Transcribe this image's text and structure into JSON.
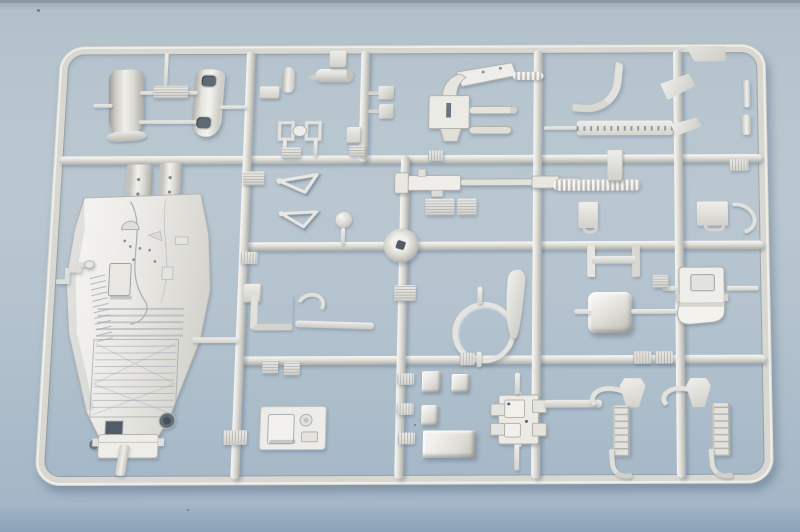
{
  "meta": {
    "type": "photograph",
    "subject": "Injection-molded plastic model kit sprue (parts runner) with unpainted light-gray parts, including a large cockpit/hull tub, intake cowls, a gun mount, a ring frame, a bucket seat, landing-gear struts and many small fittings",
    "surface": "light blue-gray tabletop with darker blue front edge at the bottom of the frame"
  },
  "palette": {
    "background_top_edge": "#8d99a4",
    "background_surface": "#b7c5cf",
    "table_edge_dark": "#8aa1b8",
    "plastic_base": "#dcdbd5",
    "plastic_highlight": "#f4f3ef",
    "plastic_shadow": "#aeada6",
    "slot_dark": "#5f6a76",
    "cast_shadow": "rgba(80,100,120,0.38)"
  },
  "sprue": {
    "frame": {
      "x": 0,
      "y": 0,
      "w": 740,
      "h": 466,
      "thickness": 9,
      "corner_radius": 26
    },
    "runners": [
      {
        "o": "h",
        "n": "runner-h1",
        "x": 6,
        "y": 121,
        "w": 728,
        "h": 9
      },
      {
        "o": "h",
        "n": "runner-h2",
        "x": 198,
        "y": 214,
        "w": 536,
        "h": 9
      },
      {
        "o": "h",
        "n": "runner-h3",
        "x": 198,
        "y": 334,
        "w": 536,
        "h": 9
      },
      {
        "o": "v",
        "n": "runner-v1",
        "x": 196,
        "y": 6,
        "w": 9,
        "h": 454
      },
      {
        "o": "v",
        "n": "runner-v2-top",
        "x": 316,
        "y": 6,
        "w": 9,
        "h": 122
      },
      {
        "o": "v",
        "n": "runner-v3",
        "x": 360,
        "y": 121,
        "w": 9,
        "h": 339
      },
      {
        "o": "v",
        "n": "runner-v4",
        "x": 497,
        "y": 6,
        "w": 9,
        "h": 454
      },
      {
        "o": "v",
        "n": "runner-v5",
        "x": 643,
        "y": 6,
        "w": 9,
        "h": 454
      }
    ],
    "parts": [
      {
        "t": "tab",
        "n": "corner-tab",
        "x": 656,
        "y": 2,
        "w": 42,
        "h": 17
      },
      {
        "t": "cowl",
        "n": "intake-cowl-left",
        "x": 54,
        "y": 26,
        "w": 36,
        "h": 74,
        "r": -3
      },
      {
        "t": "cowl2",
        "n": "intake-cowl-right",
        "x": 142,
        "y": 26,
        "w": 31,
        "h": 74,
        "r": 2
      },
      {
        "t": "stub",
        "n": "gate-bar",
        "x": 38,
        "y": 64,
        "w": 20,
        "h": 4
      },
      {
        "t": "stub",
        "n": "gate-bar",
        "x": 86,
        "y": 50,
        "w": 60,
        "h": 4
      },
      {
        "t": "stub",
        "n": "gate-bar",
        "x": 86,
        "y": 82,
        "w": 60,
        "h": 4
      },
      {
        "t": "stub",
        "n": "gate-bar",
        "x": 110,
        "y": 8,
        "w": 4,
        "h": 40
      },
      {
        "t": "stub",
        "n": "gate-bar",
        "x": 170,
        "y": 66,
        "w": 28,
        "h": 4
      },
      {
        "t": "vent",
        "n": "gate-plate",
        "x": 100,
        "y": 44,
        "w": 36,
        "h": 14
      },
      {
        "t": "cylv",
        "n": "small-cylinder",
        "x": 234,
        "y": 24,
        "w": 13,
        "h": 28
      },
      {
        "t": "bracketS",
        "n": "foot-bracket",
        "x": 211,
        "y": 45,
        "w": 21,
        "h": 14
      },
      {
        "t": "pod",
        "n": "cylinder-pod",
        "x": 268,
        "y": 26,
        "w": 40,
        "h": 15
      },
      {
        "t": "bracketS",
        "n": "pod-bracket",
        "x": 283,
        "y": 6,
        "w": 18,
        "h": 19
      },
      {
        "t": "twinframe",
        "n": "twin-frame-bracket",
        "x": 231,
        "y": 82,
        "w": 46,
        "h": 24
      },
      {
        "t": "stub",
        "n": "gate-bar",
        "x": 237,
        "y": 104,
        "w": 4,
        "h": 18
      },
      {
        "t": "stub",
        "n": "gate-bar",
        "x": 269,
        "y": 104,
        "w": 4,
        "h": 18
      },
      {
        "t": "vent",
        "n": "vent-plate",
        "x": 236,
        "y": 112,
        "w": 20,
        "h": 12
      },
      {
        "t": "vent",
        "n": "vent-plate",
        "x": 306,
        "y": 110,
        "w": 16,
        "h": 12
      },
      {
        "t": "pblock",
        "n": "pin-block",
        "x": 324,
        "y": 45,
        "w": 27,
        "h": 15
      },
      {
        "t": "pblock",
        "n": "pin-block",
        "x": 325,
        "y": 65,
        "w": 26,
        "h": 16
      },
      {
        "t": "bracketS",
        "n": "small-bracket",
        "x": 303,
        "y": 90,
        "w": 15,
        "h": 18
      },
      {
        "t": "gunmount",
        "n": "gun-mount-assembly",
        "x": 386,
        "y": 18,
        "w": 96,
        "h": 90
      },
      {
        "t": "ribrod",
        "n": "ribbed-rod",
        "x": 475,
        "y": 30,
        "w": 32,
        "h": 9
      },
      {
        "t": "tag",
        "n": "number-tag",
        "x": 388,
        "y": 116,
        "w": 16,
        "h": 11
      },
      {
        "t": "jtube",
        "n": "curved-pipe",
        "x": 540,
        "y": 18,
        "w": 40,
        "h": 50,
        "r": 6
      },
      {
        "t": "louver",
        "n": "louvered-strip",
        "x": 542,
        "y": 84,
        "w": 100,
        "h": 16
      },
      {
        "t": "stub",
        "n": "gate-bar",
        "x": 508,
        "y": 90,
        "w": 34,
        "h": 4
      },
      {
        "t": "aplate",
        "n": "angled-plate",
        "x": 630,
        "y": 34,
        "w": 36,
        "h": 26,
        "r": -8
      },
      {
        "t": "aplate",
        "n": "angled-plate",
        "x": 640,
        "y": 82,
        "w": 32,
        "h": 18,
        "r": -5
      },
      {
        "t": "pin",
        "n": "edge-pin",
        "x": 716,
        "y": 40,
        "w": 7,
        "h": 30
      },
      {
        "t": "pin",
        "n": "edge-pin",
        "x": 714,
        "y": 78,
        "w": 9,
        "h": 22
      },
      {
        "t": "post",
        "n": "hull-post",
        "x": 76,
        "y": 130,
        "w": 26,
        "h": 58
      },
      {
        "t": "post",
        "n": "hull-post",
        "x": 110,
        "y": 128,
        "w": 23,
        "h": 58
      },
      {
        "t": "hull",
        "n": "cockpit-hull",
        "x": 18,
        "y": 148,
        "w": 152,
        "h": 292
      },
      {
        "t": "crank",
        "n": "gate-crank",
        "x": 10,
        "y": 232,
        "w": 38,
        "h": 28
      },
      {
        "t": "stub",
        "n": "gate-bar",
        "x": 152,
        "y": 314,
        "w": 46,
        "h": 6
      },
      {
        "t": "strut",
        "n": "hull-strut",
        "x": 82,
        "y": 424,
        "w": 10,
        "h": 32,
        "r": 6
      },
      {
        "t": "wishbone",
        "n": "torque-link",
        "x": 230,
        "y": 140,
        "w": 50,
        "h": 26,
        "r": -4
      },
      {
        "t": "wishbone",
        "n": "torque-link",
        "x": 232,
        "y": 178,
        "w": 48,
        "h": 24,
        "r": 3
      },
      {
        "t": "vent",
        "n": "vent-plate",
        "x": 197,
        "y": 138,
        "w": 22,
        "h": 15
      },
      {
        "t": "ball",
        "n": "ball-part",
        "x": 294,
        "y": 182,
        "w": 17,
        "h": 17
      },
      {
        "t": "stub",
        "n": "gate-bar",
        "x": 300,
        "y": 199,
        "w": 4,
        "h": 18
      },
      {
        "t": "gunrod",
        "n": "gun-barrel-assembly",
        "x": 352,
        "y": 134,
        "w": 196,
        "h": 34
      },
      {
        "t": "vent",
        "n": "vent-plate",
        "x": 386,
        "y": 168,
        "w": 30,
        "h": 18
      },
      {
        "t": "vent",
        "n": "vent-plate",
        "x": 419,
        "y": 168,
        "w": 20,
        "h": 18
      },
      {
        "t": "rod",
        "n": "ribbed-belt-rod",
        "x": 518,
        "y": 148,
        "w": 90,
        "h": 12
      },
      {
        "t": "bracketS",
        "n": "foot-bracket",
        "x": 574,
        "y": 116,
        "w": 16,
        "h": 34
      },
      {
        "t": "hinge",
        "n": "hinge-bracket",
        "x": 544,
        "y": 172,
        "w": 20,
        "h": 28
      },
      {
        "t": "hinge",
        "n": "hinge-bracket",
        "x": 666,
        "y": 172,
        "w": 32,
        "h": 26
      },
      {
        "t": "hook",
        "n": "curved-hook",
        "x": 690,
        "y": 174,
        "w": 30,
        "h": 24,
        "r": 30
      },
      {
        "t": "tag",
        "n": "number-tag",
        "x": 700,
        "y": 126,
        "w": 20,
        "h": 13
      },
      {
        "t": "gatecircle",
        "n": "injection-gate",
        "x": 344,
        "y": 200,
        "w": 36,
        "h": 36
      },
      {
        "t": "tag",
        "n": "number-tag",
        "x": 198,
        "y": 224,
        "w": 17,
        "h": 13
      },
      {
        "t": "bracketS",
        "n": "small-bracket",
        "x": 202,
        "y": 258,
        "w": 18,
        "h": 20
      },
      {
        "t": "lbracket",
        "n": "l-bracket",
        "x": 210,
        "y": 270,
        "w": 36,
        "h": 30
      },
      {
        "t": "rodthin",
        "n": "thin-rod",
        "x": 256,
        "y": 298,
        "w": 80,
        "h": 7,
        "r": 2
      },
      {
        "t": "hook",
        "n": "curved-part",
        "x": 256,
        "y": 268,
        "w": 22,
        "h": 18,
        "r": -20
      },
      {
        "t": "vent",
        "n": "vent-plate",
        "x": 356,
        "y": 260,
        "w": 22,
        "h": 17
      },
      {
        "t": "ring",
        "n": "ring-frame",
        "x": 416,
        "y": 278,
        "w": 54,
        "h": 54
      },
      {
        "t": "stub",
        "n": "gate-bar",
        "x": 441,
        "y": 262,
        "w": 5,
        "h": 18
      },
      {
        "t": "stub",
        "n": "gate-bar",
        "x": 441,
        "y": 330,
        "w": 5,
        "h": 16
      },
      {
        "t": "fin",
        "n": "curved-fin",
        "x": 470,
        "y": 244,
        "w": 18,
        "h": 72,
        "r": 4
      },
      {
        "t": "hframe",
        "n": "h-frame",
        "x": 553,
        "y": 218,
        "w": 38,
        "h": 34
      },
      {
        "t": "box3d",
        "n": "equipment-box",
        "x": 554,
        "y": 268,
        "w": 45,
        "h": 43
      },
      {
        "t": "stub",
        "n": "gate-bar",
        "x": 540,
        "y": 286,
        "w": 16,
        "h": 5
      },
      {
        "t": "stub",
        "n": "gate-bar",
        "x": 598,
        "y": 286,
        "w": 46,
        "h": 5
      },
      {
        "t": "seat",
        "n": "bucket-seat",
        "x": 643,
        "y": 240,
        "w": 54,
        "h": 64
      },
      {
        "t": "stub",
        "n": "gate-bar",
        "x": 630,
        "y": 262,
        "w": 14,
        "h": 5
      },
      {
        "t": "stub",
        "n": "gate-bar",
        "x": 696,
        "y": 262,
        "w": 32,
        "h": 5
      },
      {
        "t": "vent",
        "n": "vent-plate",
        "x": 620,
        "y": 250,
        "w": 16,
        "h": 14
      },
      {
        "t": "panelcyl",
        "n": "winch-panel",
        "x": 222,
        "y": 382,
        "w": 70,
        "h": 52
      },
      {
        "t": "tag",
        "n": "number-tag",
        "x": 187,
        "y": 410,
        "w": 24,
        "h": 15
      },
      {
        "t": "vent",
        "n": "vent-plate",
        "x": 224,
        "y": 338,
        "w": 16,
        "h": 14
      },
      {
        "t": "vent",
        "n": "vent-plate",
        "x": 246,
        "y": 340,
        "w": 16,
        "h": 14
      },
      {
        "t": "tag",
        "n": "number-tag",
        "x": 361,
        "y": 352,
        "w": 17,
        "h": 12
      },
      {
        "t": "tag",
        "n": "number-tag",
        "x": 361,
        "y": 383,
        "w": 17,
        "h": 12
      },
      {
        "t": "tag",
        "n": "number-tag",
        "x": 363,
        "y": 413,
        "w": 17,
        "h": 12
      },
      {
        "t": "cube",
        "n": "small-box",
        "x": 386,
        "y": 350,
        "w": 19,
        "h": 22
      },
      {
        "t": "cube",
        "n": "small-box",
        "x": 416,
        "y": 353,
        "w": 18,
        "h": 19
      },
      {
        "t": "tag",
        "n": "number-tag",
        "x": 424,
        "y": 331,
        "w": 15,
        "h": 13
      },
      {
        "t": "cube",
        "n": "small-box",
        "x": 386,
        "y": 385,
        "w": 17,
        "h": 21
      },
      {
        "t": "tray",
        "n": "rect-tray",
        "x": 388,
        "y": 411,
        "w": 53,
        "h": 28
      },
      {
        "t": "mountplate",
        "n": "mount-plate",
        "x": 456,
        "y": 372,
        "w": 56,
        "h": 56
      },
      {
        "t": "stub",
        "n": "gate-bar",
        "x": 480,
        "y": 352,
        "w": 5,
        "h": 22
      },
      {
        "t": "stub",
        "n": "gate-bar",
        "x": 480,
        "y": 426,
        "w": 5,
        "h": 26
      },
      {
        "t": "rodthin",
        "n": "thin-rod",
        "x": 510,
        "y": 380,
        "w": 58,
        "h": 8
      },
      {
        "t": "horn",
        "n": "curved-horn",
        "x": 556,
        "y": 366,
        "w": 30,
        "h": 18,
        "r": 10
      },
      {
        "t": "flap",
        "n": "pedal-flap",
        "x": 586,
        "y": 358,
        "w": 26,
        "h": 30
      },
      {
        "t": "ladderstrut",
        "n": "gear-strut",
        "x": 579,
        "y": 386,
        "w": 13,
        "h": 52
      },
      {
        "t": "foot",
        "n": "strut-foot",
        "x": 576,
        "y": 430,
        "w": 16,
        "h": 26,
        "r": -4
      },
      {
        "t": "horn",
        "n": "curved-horn",
        "x": 628,
        "y": 366,
        "w": 30,
        "h": 18,
        "r": 10
      },
      {
        "t": "flap",
        "n": "pedal-flap",
        "x": 653,
        "y": 358,
        "w": 25,
        "h": 30
      },
      {
        "t": "ladderstrut",
        "n": "gear-strut",
        "x": 679,
        "y": 384,
        "w": 14,
        "h": 54
      },
      {
        "t": "foot",
        "n": "strut-foot",
        "x": 676,
        "y": 430,
        "w": 17,
        "h": 26,
        "r": -4
      },
      {
        "t": "tag",
        "n": "number-tag",
        "x": 600,
        "y": 330,
        "w": 18,
        "h": 13
      },
      {
        "t": "tag",
        "n": "number-tag",
        "x": 622,
        "y": 330,
        "w": 18,
        "h": 13
      }
    ]
  }
}
